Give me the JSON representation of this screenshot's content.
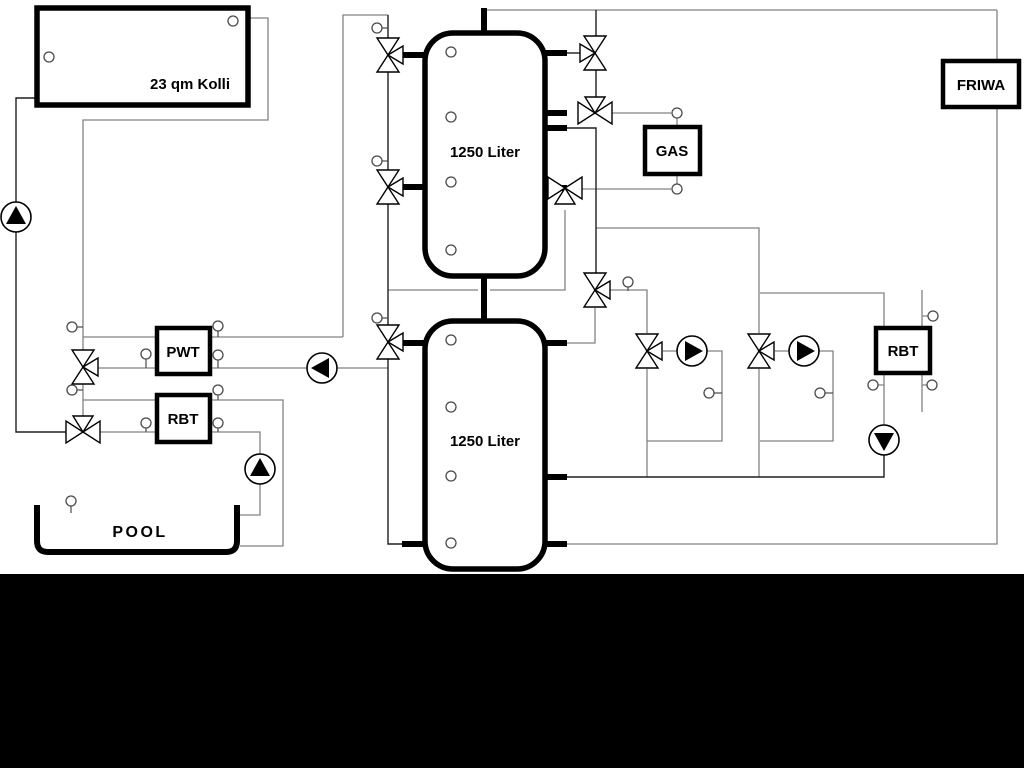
{
  "diagram": {
    "title_hint": "hydraulic heating scheme",
    "labels": {
      "collector": "23 qm Kolli",
      "tank_top": "1250 Liter",
      "tank_bottom": "1250 Liter",
      "gas_boiler": "GAS",
      "friwa_station": "FRIWA",
      "pwt_exchanger": "PWT",
      "rbt_left_exchanger": "RBT",
      "rbt_right_exchanger": "RBT",
      "pool": "POOL"
    },
    "components": {
      "three_way_valves": 11,
      "pumps": 6,
      "temperature_sensors": 29
    },
    "colors": {
      "background": "#ffffff",
      "component_stroke": "#000000",
      "pipe_gray": "#828282",
      "pipe_dark": "#1f1f1f",
      "bottom_mask": "#000000"
    }
  }
}
